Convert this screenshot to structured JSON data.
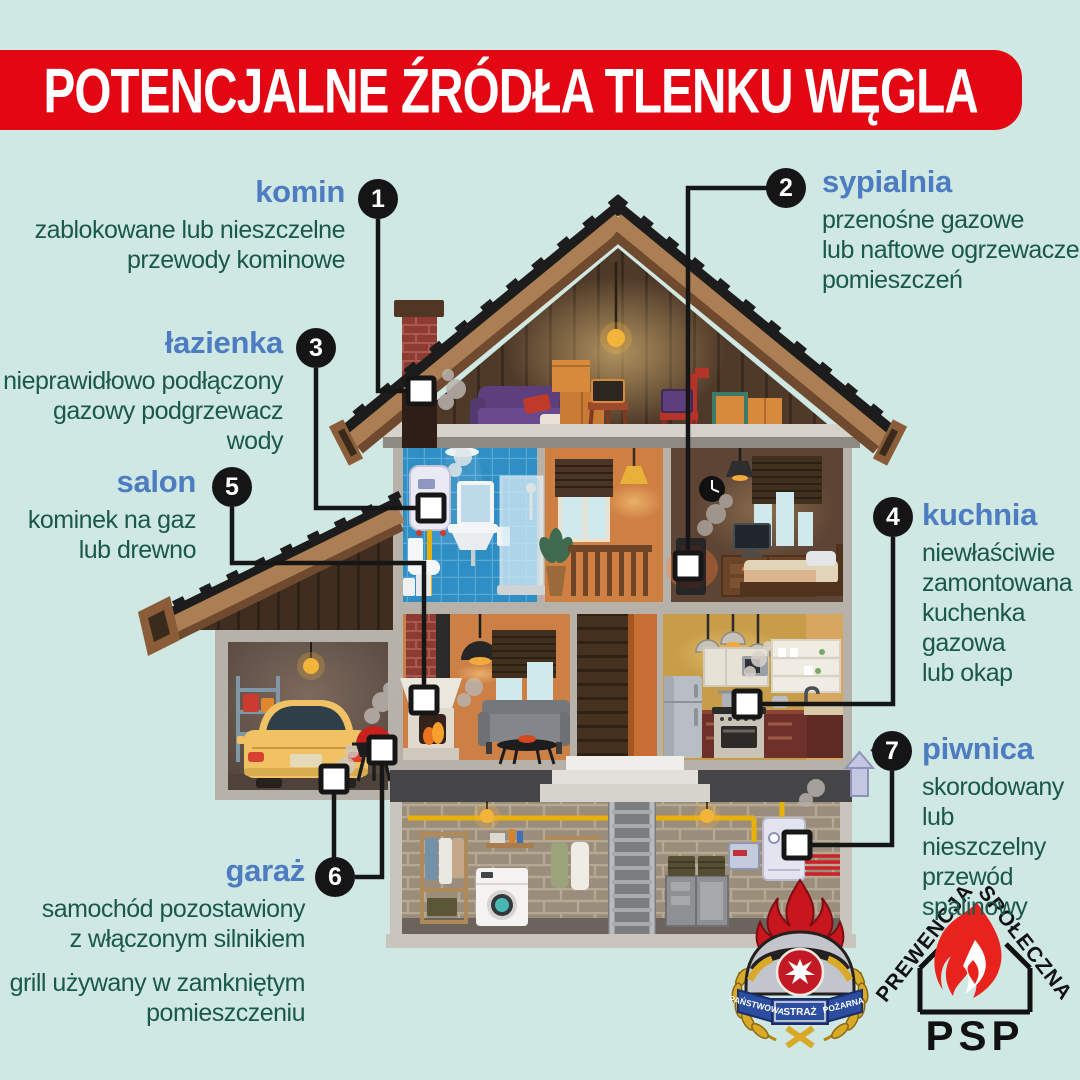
{
  "title": "POTENCJALNE ŹRÓDŁA TLENKU WĘGLA",
  "callouts": {
    "komin": {
      "number": "1",
      "heading": "komin",
      "desc": "zablokowane lub nieszczelne\nprzewody kominowe"
    },
    "sypialnia": {
      "number": "2",
      "heading": "sypialnia",
      "desc": "przenośne gazowe\nlub naftowe ogrzewacze\npomieszczeń"
    },
    "lazienka": {
      "number": "3",
      "heading": "łazienka",
      "desc": "nieprawidłowo podłączony\ngazowy podgrzewacz wody"
    },
    "kuchnia": {
      "number": "4",
      "heading": "kuchnia",
      "desc": "niewłaściwie\nzamontowana\nkuchenka\ngazowa\nlub okap"
    },
    "salon": {
      "number": "5",
      "heading": "salon",
      "desc": "kominek na gaz\nlub drewno"
    },
    "garaz": {
      "number": "6",
      "heading": "garaż",
      "desc": "samochód pozostawiony\nz włączonym silnikiem",
      "desc2": "grill używany w zamkniętym\npomieszczeniu"
    },
    "piwnica": {
      "number": "7",
      "heading": "piwnica",
      "desc": "skorodowany\nlub nieszczelny\nprzewód\nspalinowy"
    }
  },
  "logos": {
    "crest": {
      "banner_left": "PAŃSTWOWA",
      "banner_mid": "STRAŻ",
      "banner_right": "POŻARNA"
    },
    "prevention": {
      "arc_left": "PREWENCJA",
      "arc_right": "SPOŁECZNA",
      "bottom": "PSP"
    }
  },
  "colors": {
    "background": "#cfe8e3",
    "banner": "#e30613",
    "heading": "#4d7cc1",
    "body": "#1a584c",
    "line": "#161616"
  }
}
